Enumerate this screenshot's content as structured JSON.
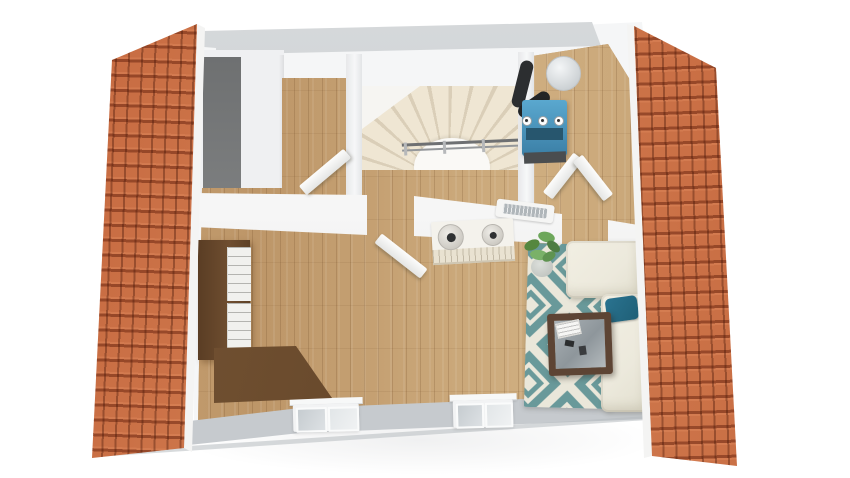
{
  "scene": {
    "type": "3d-floor-plan-top-down-render",
    "description": "Dollhouse-style overhead 3D rendering of an attic floor with the two pitched roof panels lifted off and shown beside the plan",
    "rooms": [
      {
        "name": "bedroom-top-left",
        "features": [
          "dark gray accent wall",
          "open door to hallway"
        ]
      },
      {
        "name": "stairwell",
        "features": [
          "winder staircase",
          "gray handrail",
          "white landing"
        ]
      },
      {
        "name": "utility-room-top-right",
        "features": [
          "blue boiler unit",
          "black flue pipe",
          "white expansion tank",
          "valve row",
          "double door"
        ]
      },
      {
        "name": "open-living-area",
        "features": [
          "oak plank flooring",
          "double-basin vanity cabinet",
          "wall radiator",
          "corner sofa",
          "teal pillow",
          "diamond pattern rug",
          "wood coffee table with glass top",
          "potted plant",
          "tall bookshelf",
          "corner desk",
          "two front roof windows"
        ]
      }
    ],
    "objects": [
      "roof-panel-left",
      "roof-panel-right",
      "north-wall",
      "ceiling-band",
      "west-wall",
      "bedroom-accent-wall",
      "hallway-floor",
      "staircase",
      "stair-railing",
      "utility-floor",
      "boiler",
      "flue-pipe",
      "expansion-tank",
      "interior-wall-left",
      "interior-wall-right",
      "east-wall",
      "front-wall",
      "window-left",
      "window-right",
      "main-floor",
      "bookshelf",
      "desk",
      "vanity-cabinet",
      "basin-large",
      "basin-small",
      "radiator",
      "door-bedroom",
      "door-living",
      "door-utility-left",
      "door-utility-right",
      "potted-plant",
      "area-rug",
      "coffee-table",
      "paper-stack",
      "remote-control",
      "sofa",
      "sofa-pillow"
    ],
    "colors": {
      "bg": "#ffffff",
      "roof": "#d07a4e",
      "wall": "#f5f6f7",
      "wall_gray": "#c3c7cb",
      "accent_wall": "#7d7f80",
      "front_wall": "#c6cace",
      "floor": "#c7a274",
      "stairs": "#efe6d3",
      "railing": "#6e7072",
      "cabinet": "#6f4e30",
      "desk": "#5f4227",
      "boiler": "#3b7fa6",
      "flue": "#2c2e30",
      "radiator": "#b0b6ba",
      "rug_teal": "#69999a",
      "rug_cream": "#eae7da",
      "sofa": "#ece9dc",
      "pillow": "#1f5f76",
      "table": "#5d4434",
      "plant": "#5f9350"
    }
  }
}
